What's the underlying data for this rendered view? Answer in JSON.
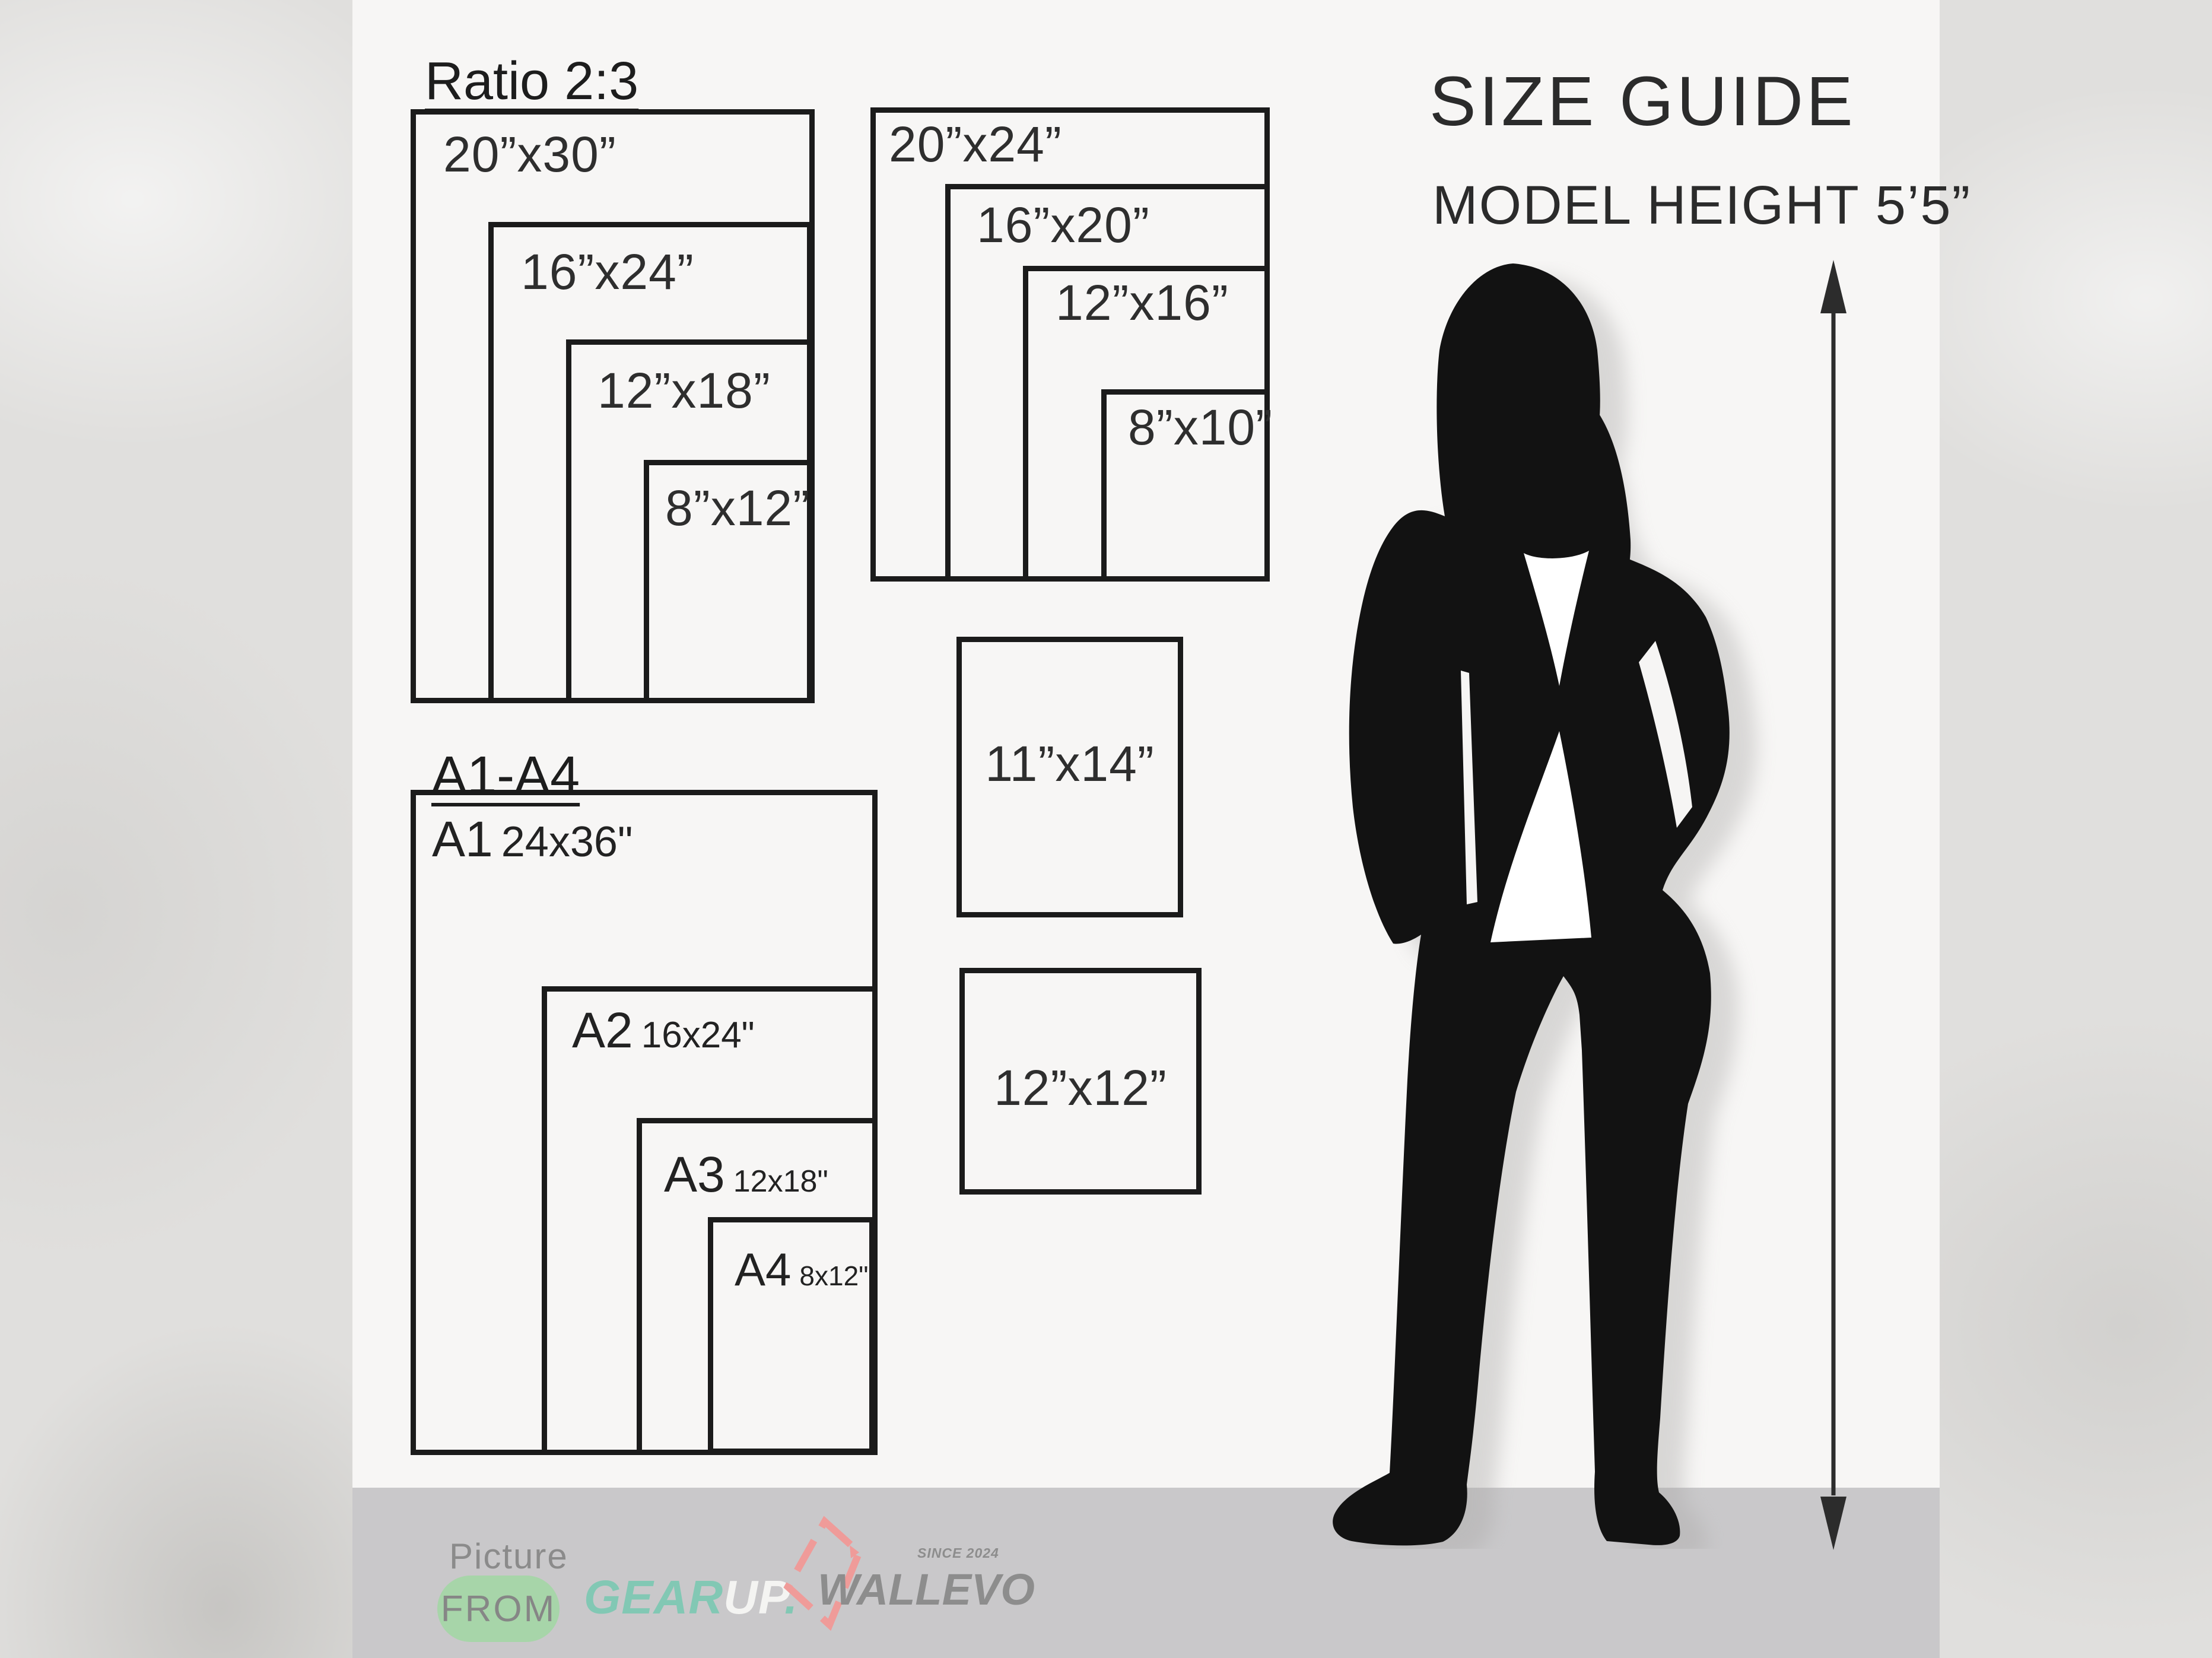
{
  "ratio23": {
    "title": "Ratio 2:3",
    "sizes": [
      "20”x30”",
      "16”x24”",
      "12”x18”",
      "8”x12”"
    ]
  },
  "standard": {
    "sizes": [
      "20”x24”",
      "16”x20”",
      "12”x16”",
      "8”x10”"
    ]
  },
  "aseries": {
    "title": "A1-A4",
    "items": [
      {
        "code": "A1",
        "size": "24x36\""
      },
      {
        "code": "A2",
        "size": "16x24\""
      },
      {
        "code": "A3",
        "size": "12x18\""
      },
      {
        "code": "A4",
        "size": "8x12\""
      }
    ]
  },
  "singles": {
    "box1": "11”x14”",
    "box2": "12”x12”"
  },
  "right": {
    "title": "SIZE GUIDE",
    "subtitle": "MODEL HEIGHT 5’5”"
  },
  "footer": {
    "picture_label": "Picture",
    "from_label": "FROM",
    "gear": "GEAR",
    "up": "UP",
    "up_dot": ".",
    "brand": "WALLEVO",
    "since": "SINCE 2024"
  },
  "colors": {
    "panel_white": "#f7f6f5",
    "footer_gray": "#c9c8ca",
    "outline_black": "#1b1b1b",
    "badge_green": "#a7d5a9",
    "gear_teal": "#82c8b4",
    "wallevo_pink": "#ef9b99",
    "logo_gray": "#8d8d8d"
  }
}
